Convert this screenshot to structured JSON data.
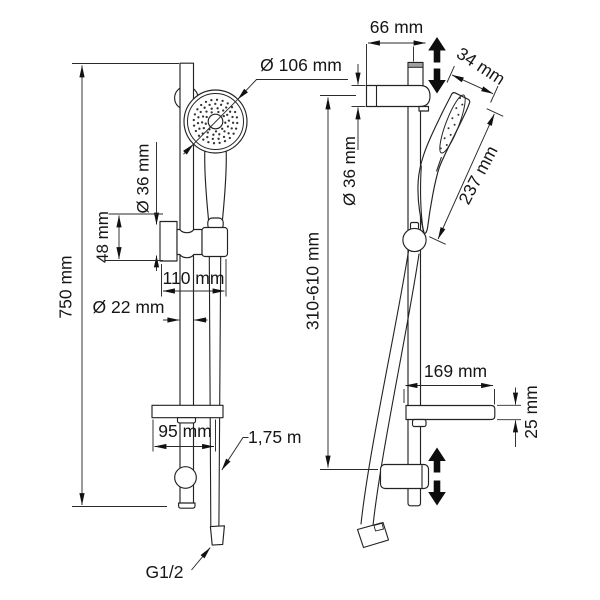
{
  "page": {
    "background": "#ffffff",
    "line_color": "#232323",
    "arrow_color": "#0d0d0d",
    "metal_gray": "#a0a0a0"
  },
  "drawing": {
    "kind": "shower-slide-rail-set dimensional drawing, front view and side view",
    "front_view": {
      "rail_length_label": "750 mm",
      "hand_shower_diameter_label": "Ø 106 mm",
      "holder_diameter_label": "Ø 36 mm",
      "holder_height_label": "48 mm",
      "holder_width_label": "110 mm",
      "rail_diameter_label": "Ø 22 mm",
      "soap_dish_width_label": "95 mm",
      "hose_length_label": "1,75 m",
      "thread_label": "G1/2"
    },
    "side_view": {
      "wall_distance_label": "66 mm",
      "head_thickness_label": "34 mm",
      "hand_shower_length_label": "237 mm",
      "bracket_diameter_label": "Ø 36 mm",
      "mounting_height_range_label": "310-610 mm",
      "soap_dish_depth_label": "169 mm",
      "soap_dish_thickness_label": "25 mm"
    }
  }
}
